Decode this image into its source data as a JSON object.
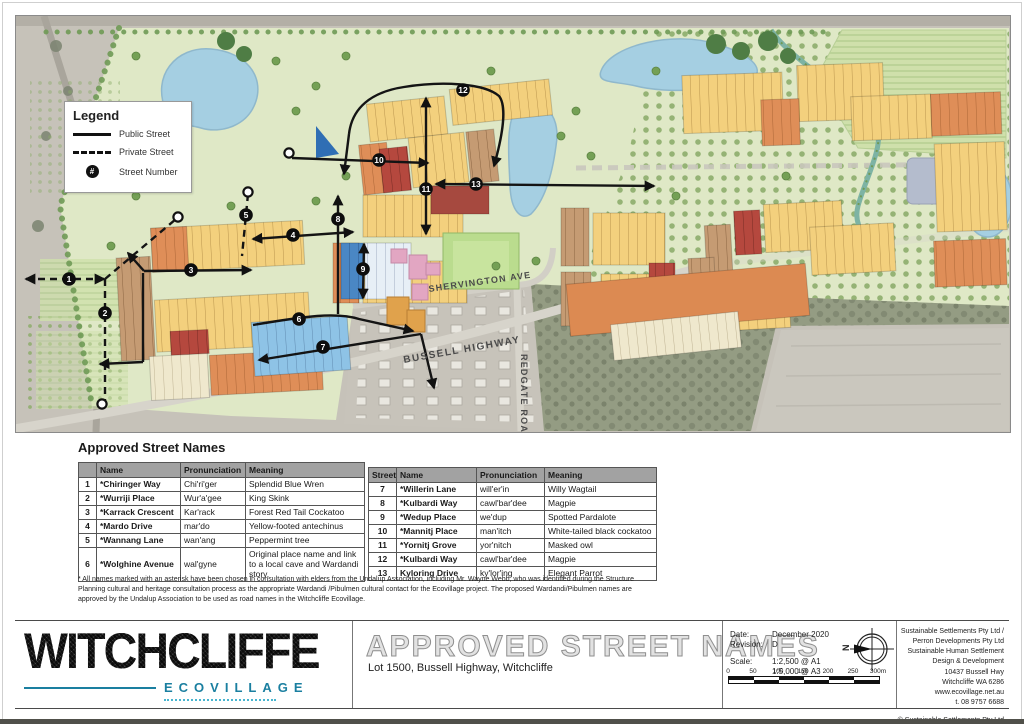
{
  "legend": {
    "title": "Legend",
    "public_label": "Public Street",
    "private_label": "Private Street",
    "number_label": "Street Number",
    "number_symbol": "#"
  },
  "map": {
    "roads": {
      "shervington": "SHERVINGTON AVE",
      "bussell": "BUSSELL HIGHWAY",
      "redgate": "REDGATE ROAD"
    },
    "numbers": [
      "1",
      "2",
      "3",
      "4",
      "5",
      "6",
      "7",
      "8",
      "9",
      "10",
      "11",
      "12",
      "13"
    ]
  },
  "streets": {
    "heading": "Approved Street Names",
    "left": {
      "h": [
        "",
        "Name",
        "Pronunciation",
        "Meaning"
      ],
      "rows": [
        [
          "1",
          "*Chiringer Way",
          "Chi'ri'ger",
          "Splendid Blue Wren"
        ],
        [
          "2",
          "*Wurriji Place",
          "Wur'a'gee",
          "King Skink"
        ],
        [
          "3",
          "*Karrack Crescent",
          "Kar'rack",
          "Forest Red Tail Cockatoo"
        ],
        [
          "4",
          "*Mardo Drive",
          "mar'do",
          "Yellow-footed antechinus"
        ],
        [
          "5",
          "*Wannang Lane",
          "wan'ang",
          "Peppermint tree"
        ],
        [
          "6",
          "*Wolghine Avenue",
          "wal'gyne",
          "Original place name and link to a local cave and Wardandi story."
        ]
      ]
    },
    "right": {
      "h": [
        "Street",
        "Name",
        "Pronunciation",
        "Meaning"
      ],
      "rows": [
        [
          "7",
          "*Willerin Lane",
          "will'er'in",
          "Willy Wagtail"
        ],
        [
          "8",
          "*Kulbardi Way",
          "cawl'bar'dee",
          "Magpie"
        ],
        [
          "9",
          "*Wedup Place",
          "we'dup",
          "Spotted Pardalote"
        ],
        [
          "10",
          "*Mannitj Place",
          "man'itch",
          "White-tailed black cockatoo"
        ],
        [
          "11",
          "*Yornitj Grove",
          "yor'nitch",
          "Masked owl"
        ],
        [
          "12",
          "*Kulbardi Way",
          "cawl'bar'dee",
          "Magpie"
        ],
        [
          "13",
          "Kyloring Drive",
          "ky'lor'ing",
          "Elegant Parrot"
        ]
      ]
    },
    "footnote": "* All names marked with an asterisk have been chosen in consultation with elders from the Undalup Association, including Mr. Wayne Webb, who was identified during the Structure Planning cultural and heritage consultation process as the appropriate Wardandi /Pibulmen cultural contact for the Ecovillage project. The proposed Wardandi/Pibulmen names are approved by the Undalup Association to be used as road names in the Witchcliffe Ecovillage."
  },
  "titleblock": {
    "logo": "WITCHCLIFFE",
    "logo_sub": "ECOVILLAGE",
    "title": "APPROVED STREET NAMES",
    "subtitle": "Lot 1500, Bussell Highway, Witchcliffe",
    "date_label": "Date:",
    "date": "December 2020",
    "rev_label": "Revision:",
    "rev": "D",
    "scale_label": "Scale:",
    "scale1": "1:2,500 @ A1",
    "scale2": "1:5,000 @ A3",
    "north": "N",
    "scalebar": [
      "0",
      "50",
      "100",
      "150",
      "200",
      "250",
      "300m"
    ],
    "company": [
      "Sustainable Settlements Pty Ltd /",
      "Perron Developments Pty Ltd",
      "Sustainable Human Settlement",
      "Design & Development",
      "10437 Bussell Hwy",
      "Witchcliffe WA 6286",
      "www.ecovillage.net.au",
      "t. 08 9757 6688"
    ],
    "copyright": "© Sustainable Settlements Pty Ltd"
  },
  "colors": {
    "teal": "#1a7fa0",
    "site_green": "#dfe8c6",
    "pond_blue": "#a5cfe2",
    "lot_yellow": "#f3d07d",
    "lot_orange": "#df8e58",
    "lot_brown": "#c59b73",
    "lot_red": "#b5483e",
    "lot_blue": "#8ec3e6"
  }
}
